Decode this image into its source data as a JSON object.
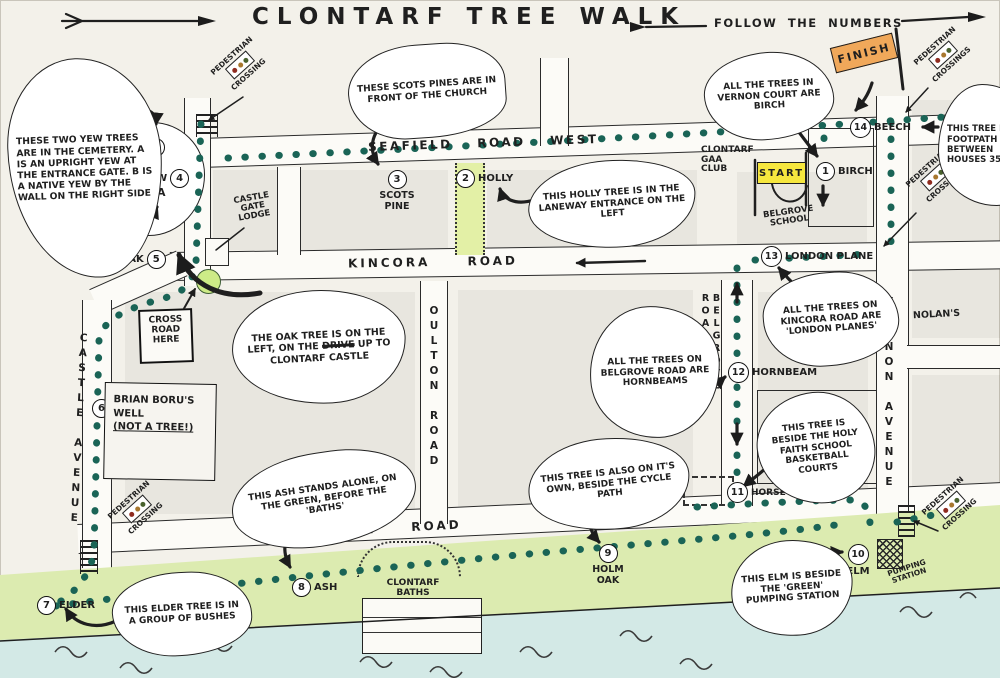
{
  "title": "CLONTARF TREE WALK",
  "subtitle": "FOLLOW THE NUMBERS",
  "banners": {
    "start": "START",
    "finish": "FINISH"
  },
  "roads": {
    "seafield": "SEAFIELD ROAD WEST",
    "kincora": "KINCORA ROAD",
    "clontarf": "CLONTARF ROAD",
    "castle": "CASTLE AVENUE",
    "oulton": "OULTON ROAD",
    "belgrove": "BELGROVE ROAD",
    "vernon": "VERNON AVENUE"
  },
  "stops": {
    "s1": {
      "num": "1",
      "label": "BIRCH"
    },
    "s2": {
      "num": "2",
      "label": "HOLLY"
    },
    "s3": {
      "num": "3",
      "label": "SCOTS PINE"
    },
    "s4a": {
      "num": "4",
      "label": "YEW",
      "sub": "A"
    },
    "s4b": {
      "num": "4",
      "label": "YEW",
      "sub": "B"
    },
    "s5": {
      "num": "5",
      "label": "OAK"
    },
    "s6": {
      "num": "6",
      "label": "BRIAN BORU'S WELL",
      "note": "(NOT A TREE!)"
    },
    "s7": {
      "num": "7",
      "label": "ELDER"
    },
    "s8": {
      "num": "8",
      "label": "ASH"
    },
    "s9": {
      "num": "9",
      "label": "HOLM OAK"
    },
    "s10": {
      "num": "10",
      "label": "ELM"
    },
    "s11": {
      "num": "11",
      "label": "HORSE CHESTNUT"
    },
    "s12": {
      "num": "12",
      "label": "HORNBEAM"
    },
    "s13": {
      "num": "13",
      "label": "LONDON PLANE"
    },
    "s14": {
      "num": "14",
      "label": "BEECH"
    }
  },
  "bubbles": {
    "yew": "THESE TWO YEW TREES ARE IN THE CEMETERY. A IS AN UPRIGHT YEW AT THE ENTRANCE GATE. B IS A NATIVE YEW BY THE WALL ON THE RIGHT SIDE",
    "scots_pine": "THESE SCOTS PINES ARE IN FRONT OF THE CHURCH",
    "holly": "THIS HOLLY TREE IS IN THE LANEWAY ENTRANCE ON THE LEFT",
    "vernon_court": "ALL THE TREES IN VERNON COURT ARE BIRCH",
    "footpath": "THIS TREE IS ON FOOTPATH BETWEEN HOUSES 35 & 37",
    "oak_pre": "THE OAK TREE IS ON THE LEFT, ON THE",
    "oak_strike": "DRIVE",
    "oak_post": "UP TO CLONTARF CASTLE",
    "kincora": "ALL THE TREES ON KINCORA ROAD ARE 'LONDON PLANES'",
    "belgrove": "ALL THE TREES ON BELGROVE ROAD ARE HORNBEAMS",
    "holy_faith": "THIS TREE IS BESIDE THE HOLY FAITH SCHOOL BASKETBALL COURTS",
    "ash": "THIS ASH STANDS ALONE, ON THE GREEN, BEFORE THE 'BATHS'",
    "cycle_path": "THIS TREE IS ALSO ON IT'S OWN, BESIDE THE CYCLE PATH",
    "elder": "THIS ELDER TREE IS IN A GROUP OF BUSHES",
    "elm": "THIS ELM IS BESIDE THE 'GREEN' PUMPING STATION"
  },
  "places": {
    "castle_gate_lodge": "CASTLE GATE LODGE",
    "clontarf_castle": "CLONTARF CASTLE",
    "gaa_club": "CLONTARF GAA CLUB",
    "belgrove_school": "BELGROVE SCHOOL",
    "clontarf_baths": "CLONTARF BATHS",
    "nolans": "NOLAN'S",
    "pumping_station": "PUMPING STATION",
    "cross_road_sign": "CROSS ROAD HERE"
  },
  "crossings": {
    "word_top": "PEDESTRIAN",
    "word_bottom": "CROSSING",
    "word_bottom_plural": "CROSSINGS"
  },
  "colors": {
    "trail": "#1a6456",
    "ink": "#1f1f1f",
    "start_flag": "#f6e73e",
    "finish_flag": "#f0a85a",
    "water": "#d3e9e6",
    "green": "#dcebb0",
    "lane_green": "#e3f0a6",
    "tree_green": "#cdeb87"
  }
}
